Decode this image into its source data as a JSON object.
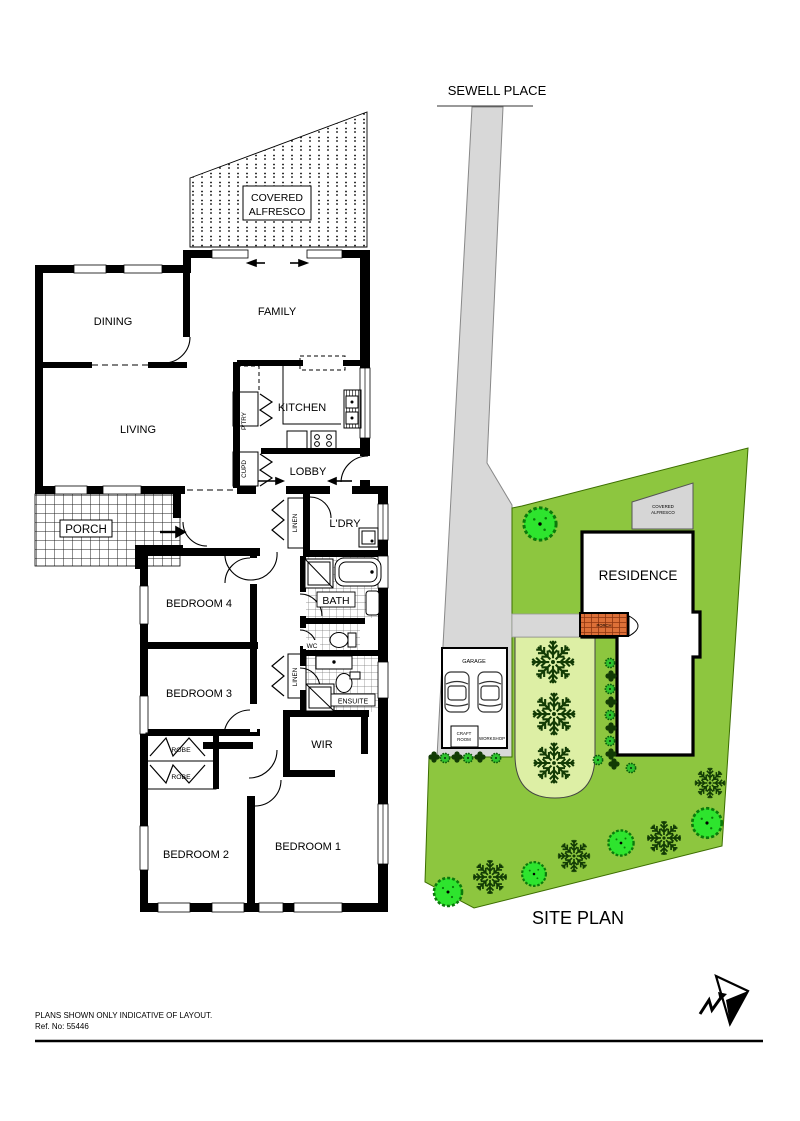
{
  "colors": {
    "lot_green": "#8DC63F",
    "garden_bed_green": "#DDEFA5",
    "road_gray": "#D8D8D8",
    "alfresco_gray": "#D6D6D6",
    "brick_orange": "#DD7038",
    "tree_green": "#2EE42E",
    "shrub_green": "#2EC32E",
    "shrub_dark_green": "#123B05",
    "wall_black": "#000000"
  },
  "floor_plan": {
    "alfresco_line1": "COVERED",
    "alfresco_line2": "ALFRESCO",
    "rooms": {
      "dining": "DINING",
      "family": "FAMILY",
      "living": "LIVING",
      "kitchen": "KITCHEN",
      "pantry": "P'TRY",
      "cupboard": "CUPD",
      "lobby": "LOBBY",
      "porch": "PORCH",
      "laundry": "L'DRY",
      "linen_hall": "LINEN",
      "bath": "BATH",
      "wc": "WC",
      "linen_bed": "LINEN",
      "ensuite": "ENSUITE",
      "wir": "WIR",
      "bedroom_4": "BEDROOM 4",
      "bedroom_3": "BEDROOM 3",
      "robe_top": "ROBE",
      "robe_bottom": "ROBE",
      "bedroom_2": "BEDROOM 2",
      "bedroom_1": "BEDROOM 1"
    }
  },
  "site_plan": {
    "street_name": "SEWELL PLACE",
    "title": "SITE PLAN",
    "residence": "RESIDENCE",
    "alfresco_line1": "COVERED",
    "alfresco_line2": "ALFRESCO",
    "garage": "GARAGE",
    "craft_room_line1": "CRAFT",
    "craft_room_line2": "ROOM",
    "workshop": "WORKSHOP",
    "porch": "PORCH"
  },
  "footer": {
    "disclaimer": "PLANS SHOWN ONLY INDICATIVE OF LAYOUT.",
    "ref_no": "Ref. No: 55446"
  }
}
